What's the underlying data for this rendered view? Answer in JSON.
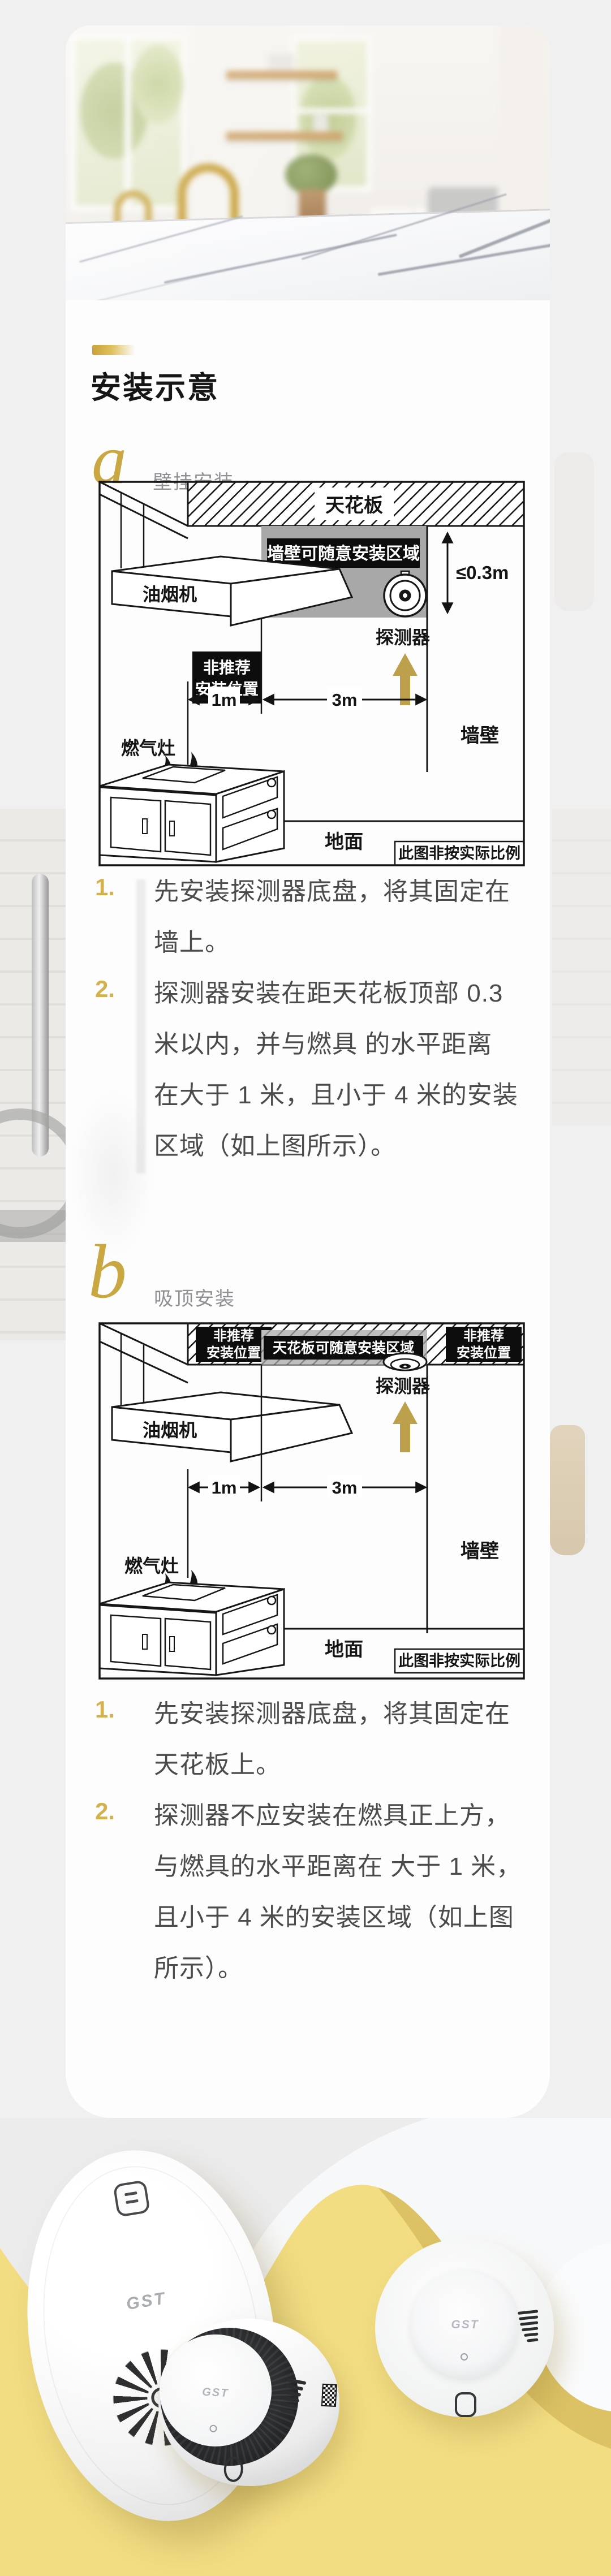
{
  "header": {
    "title": "安装示意"
  },
  "colors": {
    "accent_gold": "#c9a23d",
    "list_number_gold": "#d3b14f",
    "zone_gray": "#a8a8a8",
    "label_black": "#0d0d0d",
    "wave_yellow": "#f2dd83",
    "wave_shadow": "#d9bf62",
    "body_text": "#4b4b4b"
  },
  "sections": {
    "a": {
      "letter": "a",
      "label": "壁挂安装",
      "steps": [
        {
          "num": "1.",
          "lines": [
            "先安装探测器底盘，将其固定在",
            "墙上。"
          ]
        },
        {
          "num": "2.",
          "lines": [
            "探测器安装在距天花板顶部 0.3",
            "米以内，并与燃具 的水平距离",
            "在大于 1 米，且小于 4 米的安装",
            "区域（如上图所示）。"
          ]
        }
      ]
    },
    "b": {
      "letter": "b",
      "label": "吸顶安装",
      "steps": [
        {
          "num": "1.",
          "lines": [
            "先安装探测器底盘，将其固定在",
            "天花板上。"
          ]
        },
        {
          "num": "2.",
          "lines": [
            "探测器不应安装在燃具正上方，",
            "与燃具的水平距离在 大于 1 米，",
            "且小于 4 米的安装区域（如上图",
            "所示）。"
          ]
        }
      ]
    }
  },
  "diagram_a": {
    "ceiling": "天花板",
    "zone_label": "墙壁可随意安装区域",
    "detector": "探测器",
    "hood": "油烟机",
    "nr1": "非推荐",
    "nr2": "安装位置",
    "stove": "燃气灶",
    "wall": "墙壁",
    "floor": "地面",
    "scale_note": "此图非按实际比例",
    "d1": "1m",
    "d3": "3m",
    "d03": "≤0.3m"
  },
  "diagram_b": {
    "zone_label": "天花板可随意安装区域",
    "detector": "探测器",
    "hood": "油烟机",
    "nr1": "非推荐",
    "nr2": "安装位置",
    "stove": "燃气灶",
    "wall": "墙壁",
    "floor": "地面",
    "scale_note": "此图非按实际比例",
    "d1": "1m",
    "d3": "3m"
  },
  "products": {
    "brand": "GST"
  }
}
